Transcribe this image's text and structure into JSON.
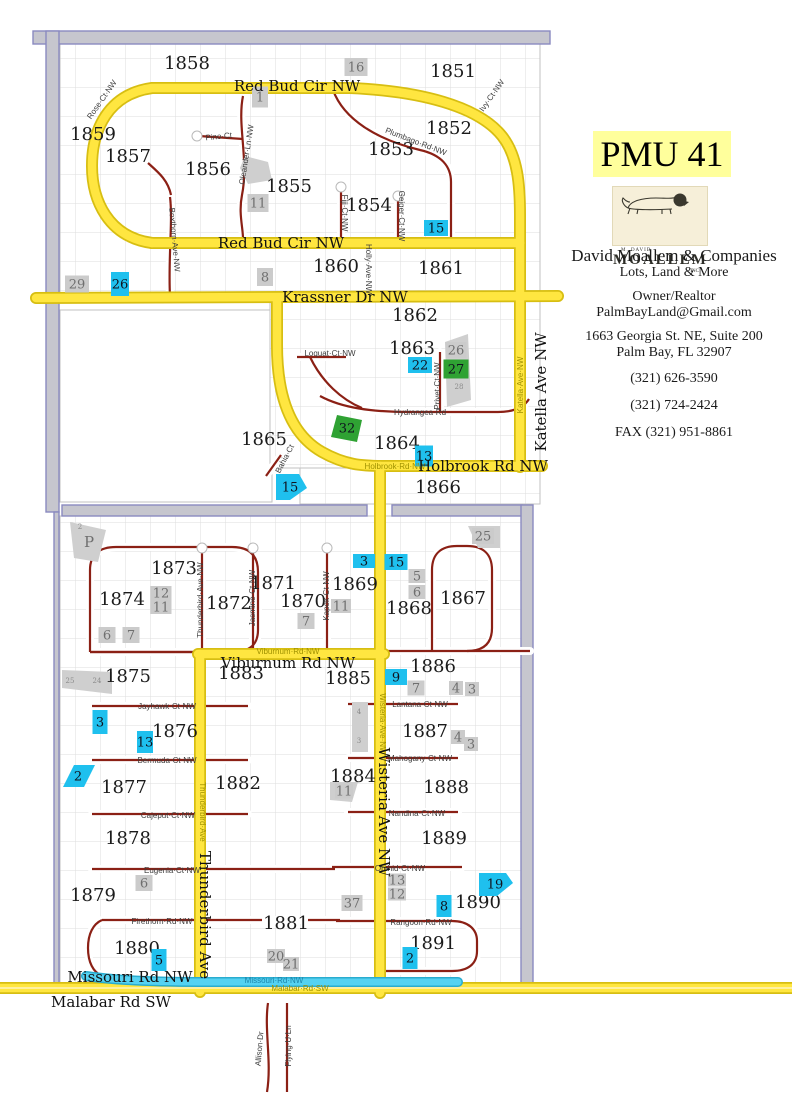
{
  "sidebar": {
    "pmu_title": "PMU 41",
    "logo": {
      "top": "M. DAVID",
      "name": "MOALLEM",
      "sub": "INC"
    },
    "company": "David Moallem & Companies",
    "tagline": "Lots, Land & More",
    "role": "Owner/Realtor",
    "email": "PalmBayLand@Gmail.com",
    "address_line1": "1663 Georgia St. NE, Suite 200",
    "address_line2": "Palm Bay, FL   32907",
    "phone1": "(321) 626-3590",
    "phone2": "(321) 724-2424",
    "fax": "FAX (321) 951-8861"
  },
  "colors": {
    "highlight_road": "#ffe640",
    "road_casing": "#d7be12",
    "minor_road": "#8b2015",
    "water_road": "#55d2f2",
    "cyan_marker": "#1fc0ee",
    "green_marker": "#2fa233",
    "gray_marker": "#cbcbcb",
    "boundary_strip": "#c6c6ce",
    "boundary_edge": "#8a8ac0",
    "pmu_bg": "#ffff9c",
    "logo_bg": "#f6efd9"
  },
  "map": {
    "blocks": [
      {
        "label": "1858",
        "x": 187,
        "y": 69
      },
      {
        "label": "1851",
        "x": 453,
        "y": 77
      },
      {
        "label": "1859",
        "x": 93,
        "y": 140
      },
      {
        "label": "1857",
        "x": 128,
        "y": 162
      },
      {
        "label": "1856",
        "x": 208,
        "y": 175
      },
      {
        "label": "1855",
        "x": 289,
        "y": 192
      },
      {
        "label": "1853",
        "x": 391,
        "y": 155
      },
      {
        "label": "1852",
        "x": 449,
        "y": 134
      },
      {
        "label": "1854",
        "x": 369,
        "y": 211
      },
      {
        "label": "1860",
        "x": 336,
        "y": 272
      },
      {
        "label": "1861",
        "x": 441,
        "y": 274
      },
      {
        "label": "1862",
        "x": 415,
        "y": 321
      },
      {
        "label": "1863",
        "x": 412,
        "y": 354
      },
      {
        "label": "1865",
        "x": 264,
        "y": 445
      },
      {
        "label": "1864",
        "x": 397,
        "y": 449
      },
      {
        "label": "1866",
        "x": 438,
        "y": 493
      },
      {
        "label": "1873",
        "x": 174,
        "y": 574
      },
      {
        "label": "1871",
        "x": 273,
        "y": 589
      },
      {
        "label": "1869",
        "x": 355,
        "y": 590
      },
      {
        "label": "1874",
        "x": 122,
        "y": 605
      },
      {
        "label": "1872",
        "x": 229,
        "y": 609
      },
      {
        "label": "1870",
        "x": 303,
        "y": 607
      },
      {
        "label": "1868",
        "x": 409,
        "y": 614
      },
      {
        "label": "1867",
        "x": 463,
        "y": 604
      },
      {
        "label": "1875",
        "x": 128,
        "y": 682
      },
      {
        "label": "1883",
        "x": 241,
        "y": 679
      },
      {
        "label": "1885",
        "x": 348,
        "y": 684
      },
      {
        "label": "1886",
        "x": 433,
        "y": 672
      },
      {
        "label": "1876",
        "x": 175,
        "y": 737
      },
      {
        "label": "1887",
        "x": 425,
        "y": 737
      },
      {
        "label": "1877",
        "x": 124,
        "y": 793
      },
      {
        "label": "1882",
        "x": 238,
        "y": 789
      },
      {
        "label": "1884",
        "x": 353,
        "y": 782
      },
      {
        "label": "1888",
        "x": 446,
        "y": 793
      },
      {
        "label": "1878",
        "x": 128,
        "y": 844
      },
      {
        "label": "1889",
        "x": 444,
        "y": 844
      },
      {
        "label": "1879",
        "x": 93,
        "y": 901
      },
      {
        "label": "1881",
        "x": 286,
        "y": 929
      },
      {
        "label": "1890",
        "x": 478,
        "y": 908
      },
      {
        "label": "1880",
        "x": 137,
        "y": 954
      },
      {
        "label": "1891",
        "x": 433,
        "y": 949
      }
    ],
    "road_labels": [
      {
        "text": "Red Bud Cir NW",
        "x": 297,
        "y": 91,
        "rot": 0
      },
      {
        "text": "Red Bud Cir NW",
        "x": 281,
        "y": 248,
        "rot": 0
      },
      {
        "text": "Krassner Dr NW",
        "x": 345,
        "y": 302,
        "rot": 0
      },
      {
        "text": "Holbrook Rd NW",
        "x": 483,
        "y": 471,
        "rot": 0
      },
      {
        "text": "Katella Ave NW",
        "x": 546,
        "y": 392,
        "rot": -90
      },
      {
        "text": "Viburnum Rd NW",
        "x": 288,
        "y": 668,
        "rot": 0
      },
      {
        "text": "Wisteria Ave NW",
        "x": 379,
        "y": 812,
        "rot": 90
      },
      {
        "text": "Thunderbird Ave",
        "x": 200,
        "y": 915,
        "rot": 90
      },
      {
        "text": "Missouri Rd NW",
        "x": 130,
        "y": 982,
        "rot": 0
      },
      {
        "text": "Malabar Rd SW",
        "x": 111,
        "y": 1007,
        "rot": 0
      }
    ],
    "street_labels": [
      {
        "text": "Rose·Ct·NW",
        "x": 104,
        "y": 101,
        "rot": -55
      },
      {
        "text": "Pino·Ct",
        "x": 219,
        "y": 139,
        "rot": -6
      },
      {
        "text": "Oleander·Ln·NW",
        "x": 249,
        "y": 155,
        "rot": -81
      },
      {
        "text": "Boxthorn·Ave·NW",
        "x": 172,
        "y": 240,
        "rot": 85
      },
      {
        "text": "Ivy·Ct·NW",
        "x": 494,
        "y": 97,
        "rot": -55
      },
      {
        "text": "Plumbago·Rd·NW",
        "x": 415,
        "y": 144,
        "rot": 21
      },
      {
        "text": "Fiji·Ct·NW",
        "x": 342,
        "y": 213,
        "rot": 90
      },
      {
        "text": "Geiger·Ct·NW",
        "x": 399,
        "y": 216,
        "rot": 90
      },
      {
        "text": "Holly·Ave·NW",
        "x": 366,
        "y": 269,
        "rot": 90
      },
      {
        "text": "Loquat·Ct·NW",
        "x": 330,
        "y": 356,
        "rot": 0
      },
      {
        "text": "Privet·Ct·NW",
        "x": 440,
        "y": 386,
        "rot": -90
      },
      {
        "text": "Hydrangea·Rd",
        "x": 420,
        "y": 415,
        "rot": 0
      },
      {
        "text": "Bahia·Ct",
        "x": 287,
        "y": 460,
        "rot": -62
      },
      {
        "text": "Thunderbird·Ave·NW",
        "x": 203,
        "y": 600,
        "rot": -90
      },
      {
        "text": "Jasmine·Ct·NW",
        "x": 255,
        "y": 598,
        "rot": -90
      },
      {
        "text": "Kapok·Ct·NW",
        "x": 329,
        "y": 596,
        "rot": -90
      },
      {
        "text": "Viburnum·Rd·NW",
        "x": 288,
        "y": 654,
        "rot": 0,
        "cls": "olive"
      },
      {
        "text": "Jayhawk·Ct·NW",
        "x": 167,
        "y": 709,
        "rot": 0
      },
      {
        "text": "Bermuda·Ct·NW",
        "x": 167,
        "y": 763,
        "rot": 0
      },
      {
        "text": "Cajeput·Ct·NW",
        "x": 168,
        "y": 818,
        "rot": 0
      },
      {
        "text": "Eugenia·Ct·NW",
        "x": 172,
        "y": 873,
        "rot": 0
      },
      {
        "text": "Firethorn·Rd·NW",
        "x": 162,
        "y": 924,
        "rot": 0
      },
      {
        "text": "Lantana·Ct·NW",
        "x": 420,
        "y": 707,
        "rot": 0
      },
      {
        "text": "Mahogany·Ct·NW",
        "x": 420,
        "y": 761,
        "rot": 0
      },
      {
        "text": "Nandina·Ct·NW",
        "x": 417,
        "y": 816,
        "rot": 0
      },
      {
        "text": "Orchid·Ct·NW",
        "x": 400,
        "y": 871,
        "rot": 0
      },
      {
        "text": "Rangoon·Rd·NW",
        "x": 421,
        "y": 925,
        "rot": 0
      },
      {
        "text": "Wisteria·Ave·NW",
        "x": 380,
        "y": 724,
        "rot": 90,
        "cls": "olive"
      },
      {
        "text": "Thunderbird·Ave",
        "x": 200,
        "y": 812,
        "rot": 90,
        "cls": "olive"
      },
      {
        "text": "Katella·Ave·NW",
        "x": 523,
        "y": 385,
        "rot": -90,
        "cls": "olive"
      },
      {
        "text": "Holbrook·Rd·NW",
        "x": 395,
        "y": 469,
        "rot": 0,
        "cls": "olive"
      },
      {
        "text": "Missouri·Rd·NW",
        "x": 274,
        "y": 983,
        "rot": 0,
        "cls": "cyanl"
      },
      {
        "text": "Malabar·Rd·SW",
        "x": 300,
        "y": 991,
        "rot": 0,
        "cls": "olive"
      },
      {
        "text": "Allison·Dr",
        "x": 262,
        "y": 1049,
        "rot": -85
      },
      {
        "text": "Flying·U·Ln",
        "x": 291,
        "y": 1046,
        "rot": -90
      }
    ],
    "tiny_labels": [
      {
        "text": "2",
        "x": 80,
        "y": 529
      },
      {
        "text": "25",
        "x": 70,
        "y": 683
      },
      {
        "text": "24",
        "x": 97,
        "y": 683
      },
      {
        "text": "4",
        "x": 359,
        "y": 714
      },
      {
        "text": "3",
        "x": 359,
        "y": 743
      },
      {
        "text": "28",
        "x": 459,
        "y": 389
      }
    ],
    "markers": [
      {
        "v": "15",
        "c": "cyan",
        "x": 436,
        "y": 228,
        "w": 24,
        "h": 16
      },
      {
        "v": "26",
        "c": "cyan",
        "x": 120,
        "y": 284,
        "w": 18,
        "h": 24
      },
      {
        "v": "22",
        "c": "cyan",
        "x": 420,
        "y": 365,
        "w": 24,
        "h": 16
      },
      {
        "v": "13",
        "c": "cyan",
        "x": 424,
        "y": 456,
        "w": 18,
        "h": 21
      },
      {
        "v": "15",
        "c": "cyan",
        "x": 290,
        "y": 487,
        "poly": "276,474 299,474 307,488 290,500 276,500"
      },
      {
        "v": "3",
        "c": "cyan",
        "x": 364,
        "y": 561,
        "w": 22,
        "h": 14
      },
      {
        "v": "15",
        "c": "cyan",
        "x": 396,
        "y": 562,
        "w": 23,
        "h": 16
      },
      {
        "v": "9",
        "c": "cyan",
        "x": 396,
        "y": 677,
        "w": 22,
        "h": 16
      },
      {
        "v": "3",
        "c": "cyan",
        "x": 100,
        "y": 722,
        "w": 15,
        "h": 24
      },
      {
        "v": "13",
        "c": "cyan",
        "x": 145,
        "y": 742,
        "w": 16,
        "h": 22
      },
      {
        "v": "2",
        "c": "cyan",
        "x": 78,
        "y": 776,
        "poly": "63,787 74,765 95,765 84,787"
      },
      {
        "v": "19",
        "c": "cyan",
        "x": 495,
        "y": 884,
        "poly": "479,873 506,873 513,883 497,896 479,896"
      },
      {
        "v": "8",
        "c": "cyan",
        "x": 444,
        "y": 906,
        "w": 15,
        "h": 22
      },
      {
        "v": "2",
        "c": "cyan",
        "x": 410,
        "y": 958,
        "w": 15,
        "h": 22
      },
      {
        "v": "5",
        "c": "cyan",
        "x": 159,
        "y": 960,
        "w": 15,
        "h": 22
      },
      {
        "v": "27",
        "c": "green",
        "x": 456,
        "y": 369,
        "w": 25,
        "h": 19
      },
      {
        "v": "32",
        "c": "green",
        "x": 347,
        "y": 428,
        "poly": "337,415 362,420 357,442 331,437"
      },
      {
        "v": "16",
        "c": "gray",
        "x": 356,
        "y": 67,
        "w": 23,
        "h": 18
      },
      {
        "v": "1",
        "c": "gray",
        "x": 260,
        "y": 97,
        "w": 16,
        "h": 21
      },
      {
        "v": "11",
        "c": "gray",
        "x": 258,
        "y": 203,
        "w": 21,
        "h": 18
      },
      {
        "v": "8",
        "c": "gray",
        "x": 265,
        "y": 277,
        "w": 16,
        "h": 18
      },
      {
        "v": "29",
        "c": "gray",
        "x": 77,
        "y": 284,
        "w": 24,
        "h": 17
      },
      {
        "v": "26",
        "c": "gray",
        "x": 456,
        "y": 350,
        "w": 21,
        "h": 16
      },
      {
        "v": "25",
        "c": "gray",
        "x": 483,
        "y": 536,
        "w": 22,
        "h": 16
      },
      {
        "v": "12",
        "c": "gray",
        "x": 161,
        "y": 593,
        "w": 21,
        "h": 14
      },
      {
        "v": "11",
        "c": "gray",
        "x": 161,
        "y": 607,
        "w": 21,
        "h": 14
      },
      {
        "v": "6",
        "c": "gray",
        "x": 107,
        "y": 635,
        "w": 17,
        "h": 16
      },
      {
        "v": "7",
        "c": "gray",
        "x": 131,
        "y": 635,
        "w": 17,
        "h": 16
      },
      {
        "v": "7",
        "c": "gray",
        "x": 306,
        "y": 621,
        "w": 17,
        "h": 16
      },
      {
        "v": "5",
        "c": "gray",
        "x": 417,
        "y": 576,
        "w": 17,
        "h": 14
      },
      {
        "v": "6",
        "c": "gray",
        "x": 417,
        "y": 592,
        "w": 17,
        "h": 14
      },
      {
        "v": "11",
        "c": "gray",
        "x": 341,
        "y": 606,
        "w": 20,
        "h": 14
      },
      {
        "v": "7",
        "c": "gray",
        "x": 416,
        "y": 688,
        "w": 17,
        "h": 15
      },
      {
        "v": "4",
        "c": "gray",
        "x": 456,
        "y": 688,
        "w": 14,
        "h": 14
      },
      {
        "v": "3",
        "c": "gray",
        "x": 472,
        "y": 689,
        "w": 14,
        "h": 14
      },
      {
        "v": "4",
        "c": "gray",
        "x": 458,
        "y": 737,
        "w": 14,
        "h": 14
      },
      {
        "v": "3",
        "c": "gray",
        "x": 471,
        "y": 744,
        "w": 14,
        "h": 14
      },
      {
        "v": "11",
        "c": "gray",
        "x": 344,
        "y": 791,
        "w": 18,
        "h": 15
      },
      {
        "v": "13",
        "c": "gray",
        "x": 397,
        "y": 880,
        "w": 18,
        "h": 13
      },
      {
        "v": "12",
        "c": "gray",
        "x": 397,
        "y": 894,
        "w": 18,
        "h": 13
      },
      {
        "v": "37",
        "c": "gray",
        "x": 352,
        "y": 903,
        "w": 21,
        "h": 16
      },
      {
        "v": "20",
        "c": "gray",
        "x": 276,
        "y": 956,
        "w": 18,
        "h": 14
      },
      {
        "v": "21",
        "c": "gray",
        "x": 291,
        "y": 964,
        "w": 16,
        "h": 14
      },
      {
        "v": "6",
        "c": "gray",
        "x": 144,
        "y": 883,
        "w": 17,
        "h": 16
      }
    ],
    "area_label_p": "P"
  }
}
